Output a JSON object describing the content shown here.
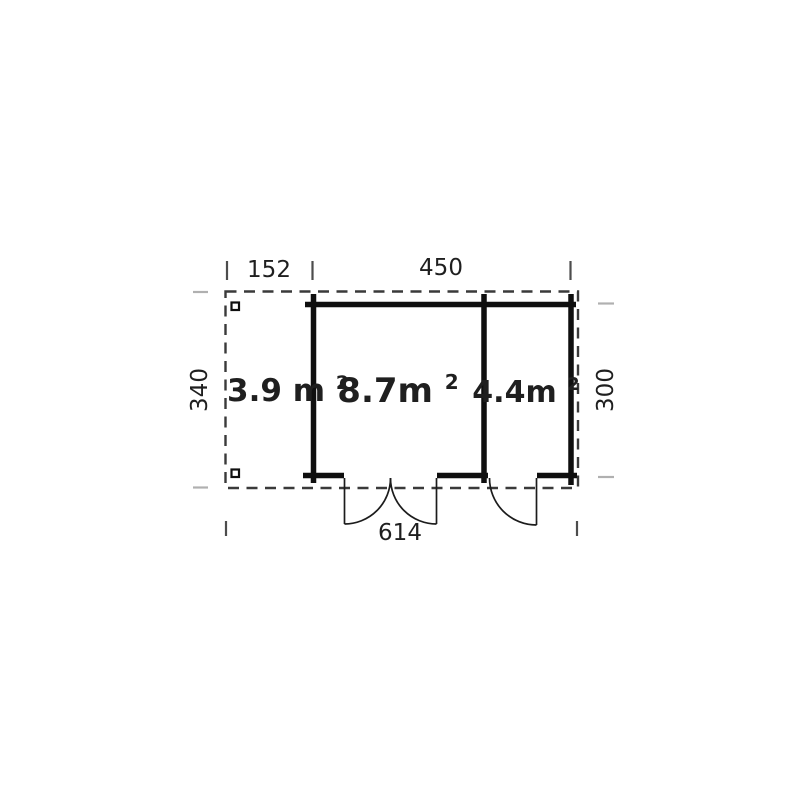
{
  "plan": {
    "type": "floor-plan",
    "dimensions": {
      "porch_width": {
        "label": "152"
      },
      "cabin_width": {
        "label": "450"
      },
      "overall_depth": {
        "label": "340"
      },
      "cabin_depth": {
        "label": "300"
      },
      "overall_width": {
        "label": "614"
      }
    },
    "rooms": {
      "porch": {
        "area_text": "3.9 m²",
        "base": "3.9 m",
        "sup": "2"
      },
      "main": {
        "area_text": "8.7m²",
        "base": "8.7m",
        "sup": "2"
      },
      "side": {
        "area_text": "4.4m²",
        "base": "4.4m",
        "sup": "2"
      }
    },
    "colors": {
      "background": "#ffffff",
      "wall": "#0f0f0f",
      "dashed_outline": "#3a3a3a",
      "door_line": "#1c1c1c",
      "text": "#1f1f1f",
      "tick_dark": "#4d4d4d",
      "tick_light": "#b0b0b0"
    }
  }
}
